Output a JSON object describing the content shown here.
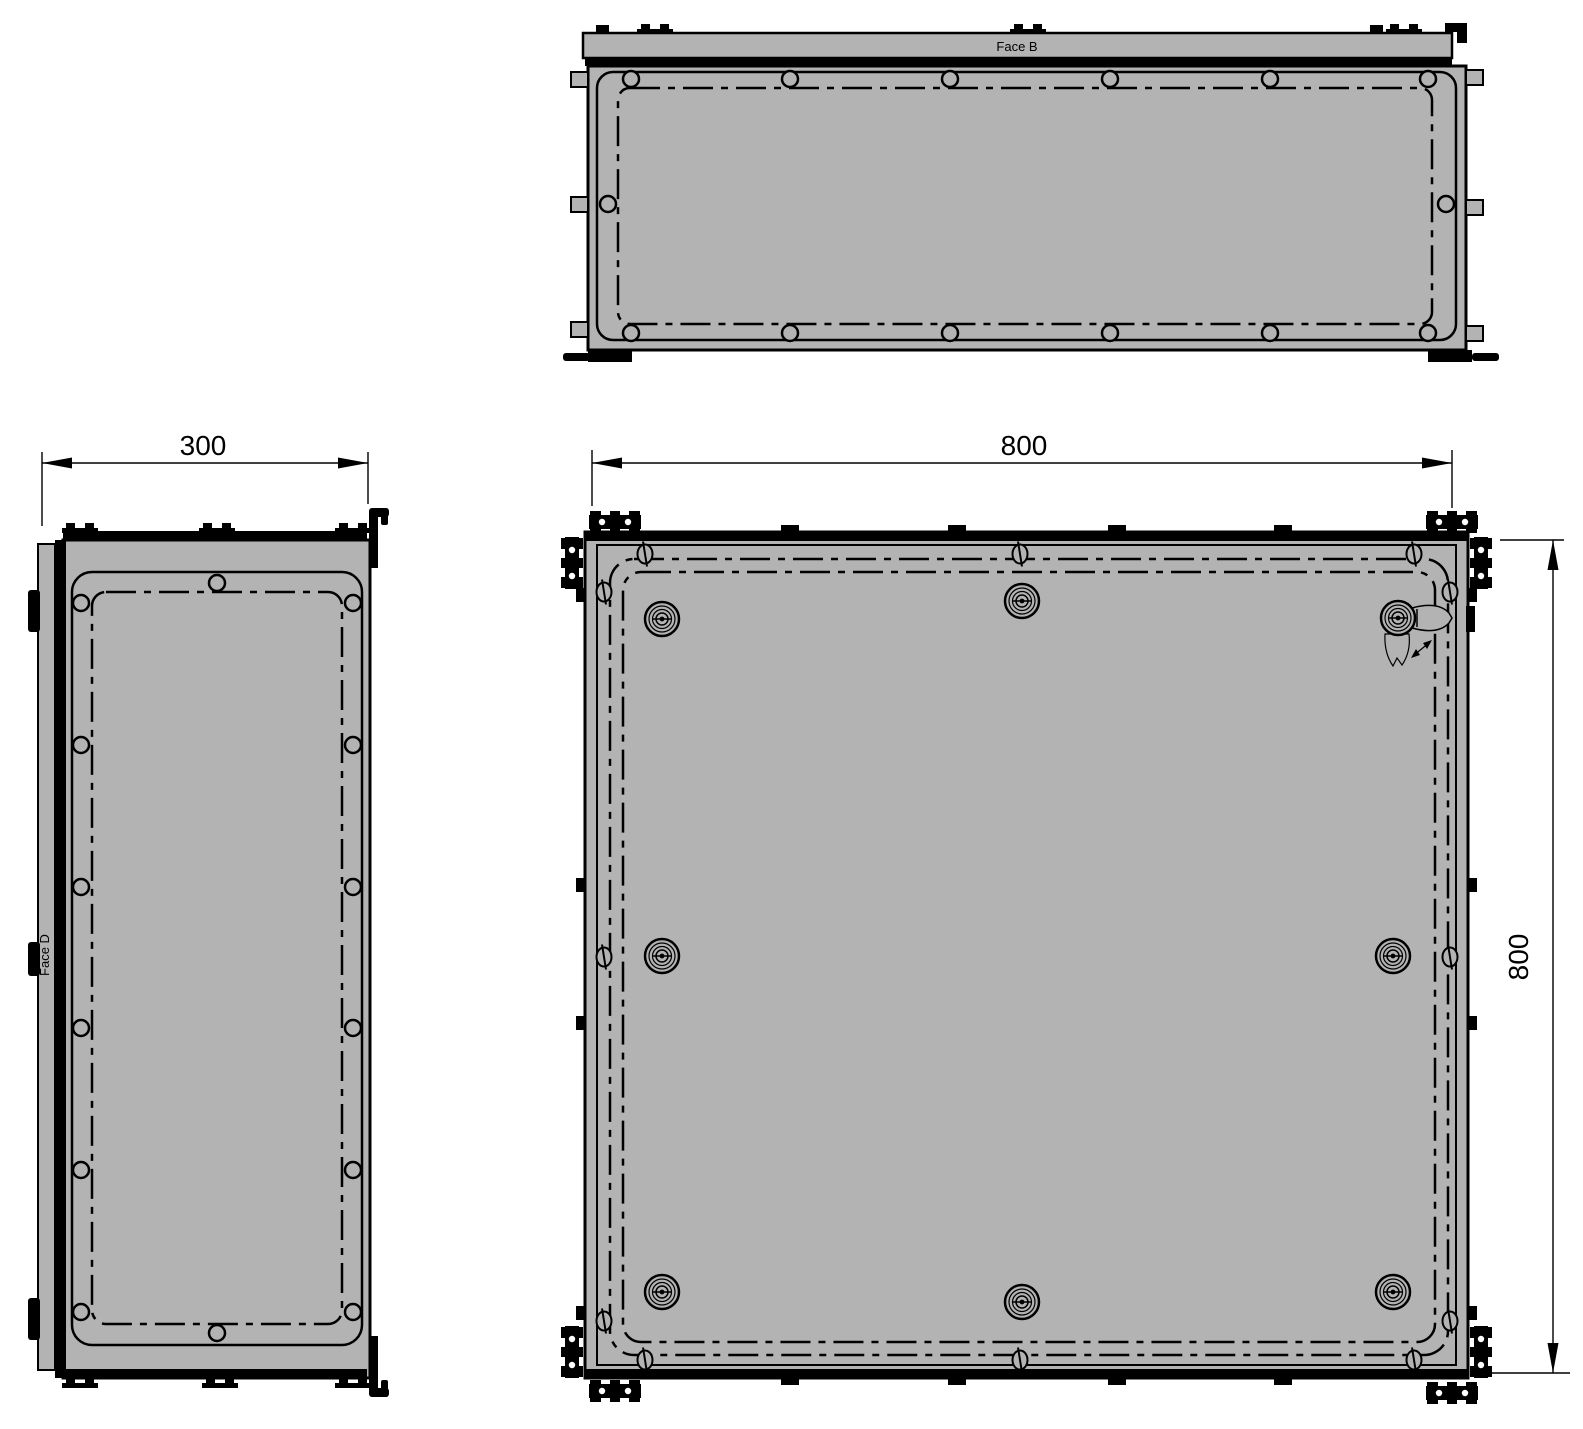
{
  "drawing": {
    "views": {
      "top": {
        "face_label": "Face B"
      },
      "side": {
        "face_label": "Face D",
        "width_dimension": "300"
      },
      "front": {
        "width_dimension": "800",
        "height_dimension": "800"
      }
    },
    "colors": {
      "background": "#ffffff",
      "panel_fill": "#b3b3b3",
      "line": "#000000"
    },
    "symbols": {
      "quarter_turn_fastener": "concentric-circles-lock",
      "slotted_screw": "oval-with-slot",
      "corner_profile": "t-slot-extrusion-cross-section",
      "centerline": "dash-dot-rounded-rectangle"
    }
  }
}
